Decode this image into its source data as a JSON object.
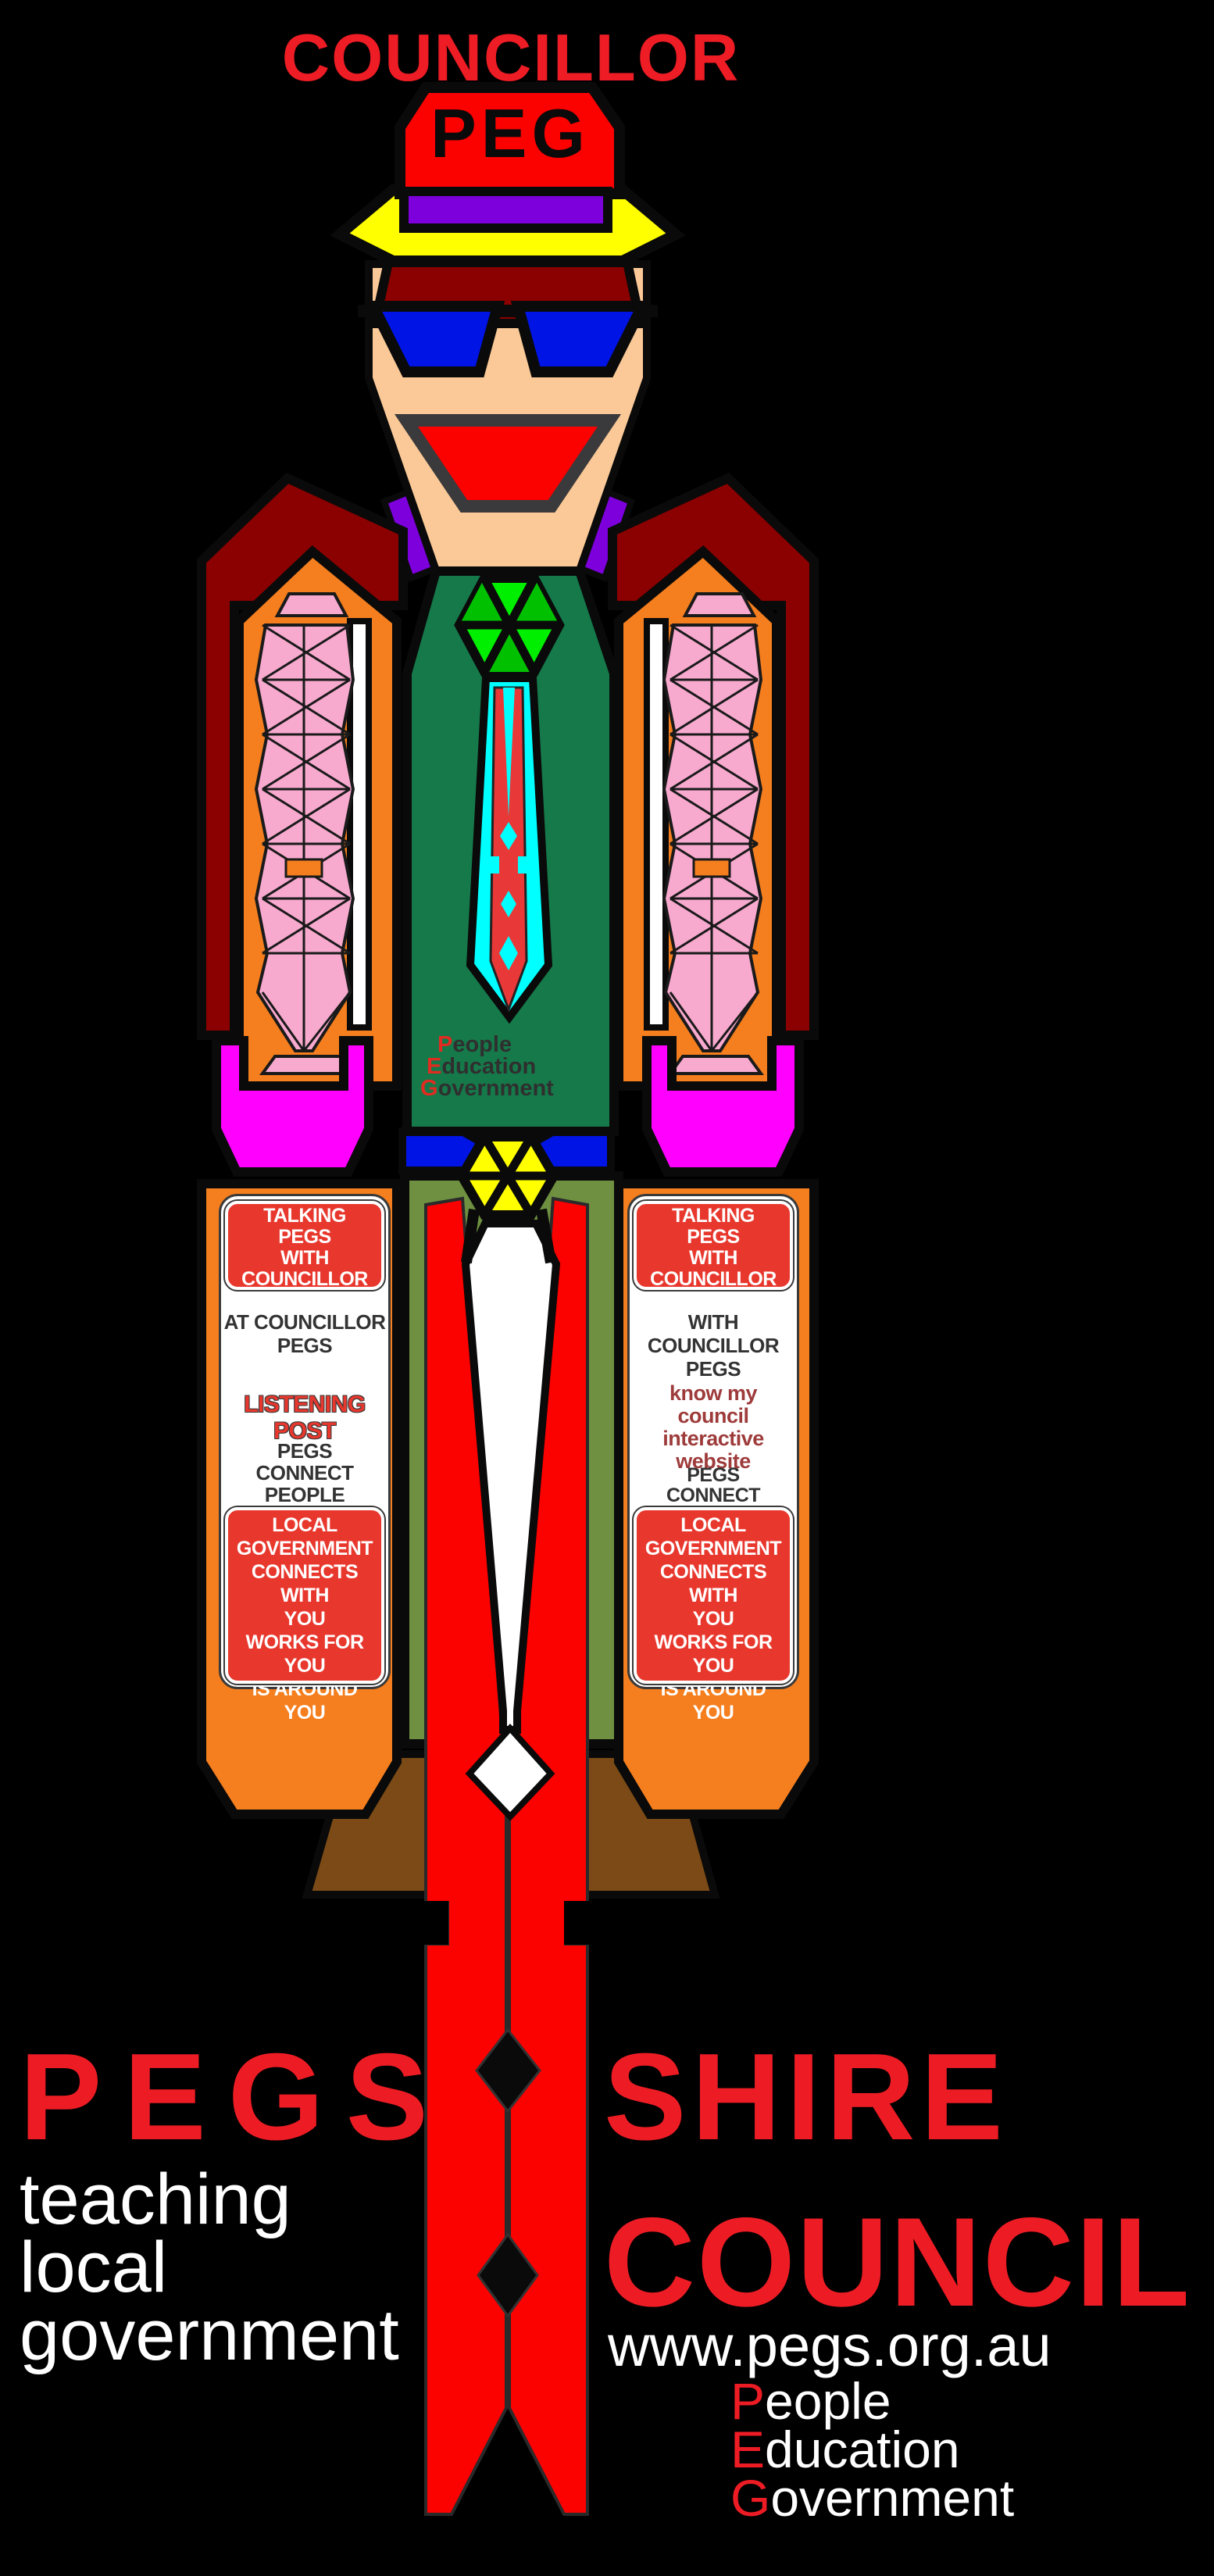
{
  "title": "COUNCILLOR",
  "hat": {
    "label": "PEG"
  },
  "torso_acronym": {
    "lines": [
      {
        "initial": "P",
        "rest": "eople"
      },
      {
        "initial": "E",
        "rest": "ducation"
      },
      {
        "initial": "G",
        "rest": "overnment"
      }
    ]
  },
  "panels": {
    "left": {
      "header": [
        "TALKING",
        "PEGS",
        "WITH COUNCILLOR",
        "PEG"
      ],
      "body_top": [
        "AT COUNCILLOR",
        "PEGS"
      ],
      "highlight": "LISTENING POST",
      "body_bottom": [
        "PEGS",
        "CONNECT PEOPLE"
      ],
      "footer": [
        "LOCAL GOVERNMENT",
        "CONNECTS WITH",
        "YOU",
        "WORKS FOR",
        "YOU",
        "IS AROUND",
        "YOU"
      ]
    },
    "right": {
      "header": [
        "TALKING",
        "PEGS",
        "WITH COUNCILLOR",
        "PEG"
      ],
      "body_top": [
        "WITH COUNCILLOR",
        "PEGS"
      ],
      "highlight": [
        "know my",
        "council",
        "interactive",
        "website"
      ],
      "body_bottom": [
        "PEGS",
        "CONNECT PEOPLE"
      ],
      "footer": [
        "LOCAL GOVERNMENT",
        "CONNECTS WITH",
        "YOU",
        "WORKS FOR",
        "YOU",
        "IS AROUND",
        "YOU"
      ]
    }
  },
  "footer": {
    "brand_left": "PEGS",
    "brand_right_top": "SHIRE",
    "brand_right_bottom": "COUNCIL",
    "tagline": [
      "teaching",
      "local",
      "government"
    ],
    "website": "www.pegs.org.au",
    "acronym": {
      "lines": [
        {
          "initial": "P",
          "rest": "eople"
        },
        {
          "initial": "E",
          "rest": "ducation"
        },
        {
          "initial": "G",
          "rest": "overnment"
        }
      ]
    }
  },
  "colors": {
    "background": "#000000",
    "figure_red": "#fb0100",
    "sign_red": "#e8382e",
    "text_red": "#ee1c24",
    "maroon": "#8b0000",
    "orange": "#f57e1e",
    "magenta": "#ff00ff",
    "pink": "#f7a9ce",
    "yellow": "#ffff00",
    "dark_green": "#15794a",
    "bright_green": "#00ee00",
    "olive": "#6e9040",
    "blue": "#0014e6",
    "purple": "#7d00dc",
    "cyan": "#00ffff",
    "skin": "#fbc997",
    "brown": "#7b4a16",
    "white": "#ffffff"
  }
}
